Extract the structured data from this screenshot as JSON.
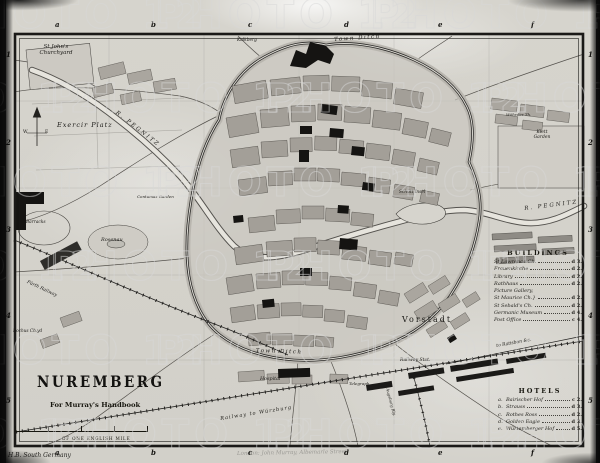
{
  "map": {
    "title": "NUREMBERG",
    "subtitle": "For Murray's Handbook",
    "scale_label": "OF ONE ENGLISH MILE",
    "imprint_left": "H.B. South Germany",
    "imprint_center": "London: John Murray, Albemarle Street.",
    "watermark": "PHOTO 12",
    "grid": {
      "columns": [
        "a",
        "b",
        "c",
        "d",
        "e",
        "f"
      ],
      "rows": [
        "1",
        "2",
        "3",
        "4",
        "5"
      ]
    },
    "labels": {
      "st_johns_1": "St John's",
      "st_johns_2": "Churchyard",
      "exercir_platz": "Exercir Platz",
      "rosenau": "Rosenau",
      "barracks": "Barracks",
      "kalkberg": "Kalkberg",
      "town_ditch_top": "Town Ditch",
      "town_ditch_bottom": "Town Ditch",
      "schuett_insel": "Schütt Insel",
      "pegnitz_west": "R. PEGNITZ",
      "pegnitz_east": "R. PEGNITZ",
      "klett_1": "Klett",
      "klett_2": "Garden",
      "vorstadt": "Vorstadt",
      "hospital": "Hospital",
      "telegraph": "Telegraph",
      "railway_stat": "Railway Stat.",
      "railway_wurzburg": "Railway to Würzburg",
      "railway_ratisbon": "to Ratisbon &c.",
      "railway_furth": "Fürth Railway",
      "augsburg": "Augsburg Rly.",
      "rochus": "Rochus Ch.yd",
      "wohrder_th": "Wöhrder Th.",
      "contumaz_garden": "Contumaz Garden",
      "compass_w": "W",
      "compass_e": "E"
    },
    "legend_buildings": {
      "title": "BUILDINGS",
      "entries": [
        {
          "name": "St Lawrence Ch.",
          "ref": "d 3."
        },
        {
          "name": "Frauenkirche",
          "ref": "d 2."
        },
        {
          "name": "Library",
          "ref": "d 2."
        },
        {
          "name": "Rathhaus",
          "ref": "d 2."
        },
        {
          "name": "Picture Gallery,",
          "ref": ""
        },
        {
          "name": "St Maurice Ch.}",
          "ref": "d 2."
        },
        {
          "name": "St Sebald's Ch.",
          "ref": "d 2."
        },
        {
          "name": "Germanic Museum",
          "ref": "d 4."
        },
        {
          "name": "Post Office",
          "ref": "c 4."
        }
      ]
    },
    "legend_hotels": {
      "title": "HOTELS",
      "entries": [
        {
          "key": "a.",
          "name": "Bairischer Hof",
          "ref": "c 2."
        },
        {
          "key": "b.",
          "name": "Strauss",
          "ref": "d 3."
        },
        {
          "key": "c.",
          "name": "Rothes Ross",
          "ref": "d 2."
        },
        {
          "key": "d.",
          "name": "Golden Eagle",
          "ref": "d 3."
        },
        {
          "key": "e.",
          "name": "Würtemberger Hof",
          "ref": "d 5."
        }
      ]
    }
  }
}
